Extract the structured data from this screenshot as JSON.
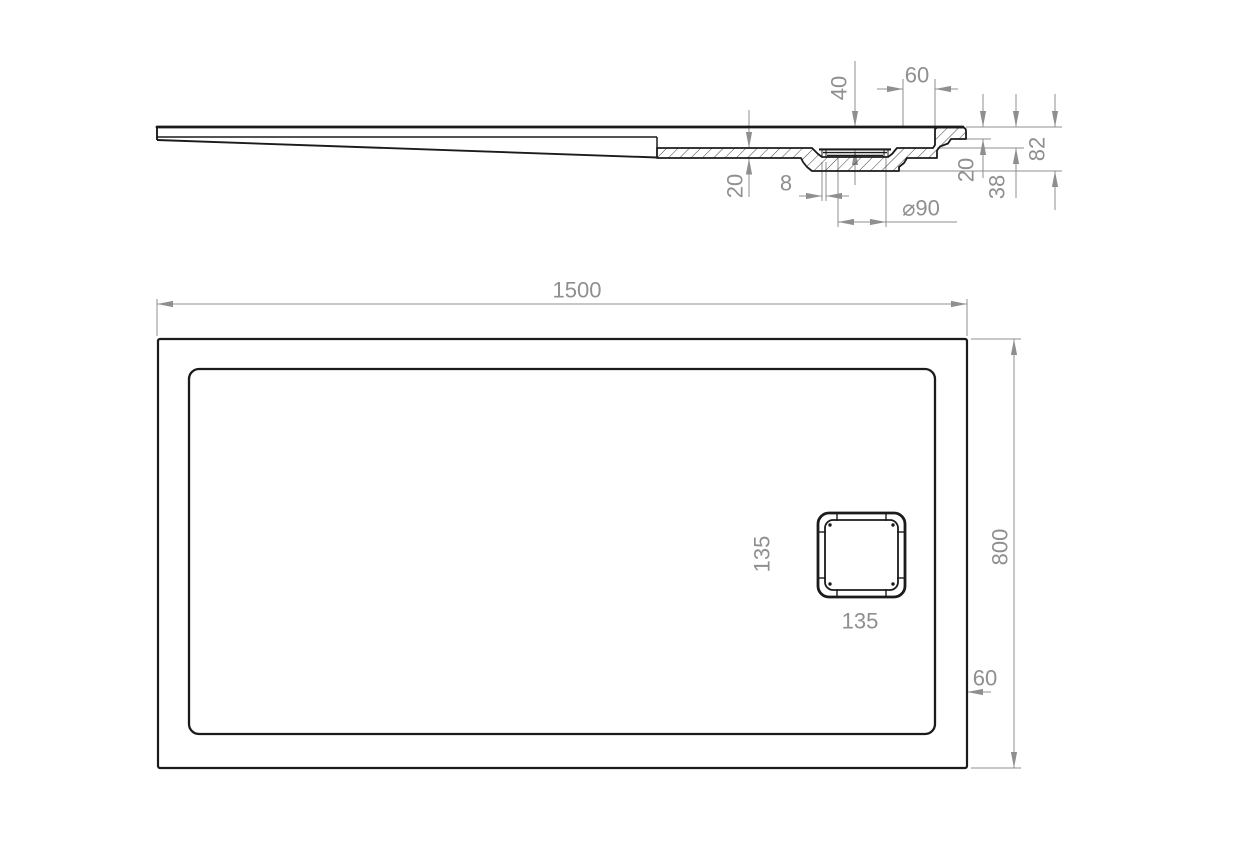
{
  "colors": {
    "drawing_line": "#1b1b1b",
    "dimension": "#8f8f8f",
    "background": "#ffffff"
  },
  "section_view": {
    "dims": {
      "drain_depth": "40",
      "drain_to_wall": "60",
      "base_thickness": "20",
      "lip": "8",
      "drain_diameter": "⌀90",
      "edge_step": "20",
      "edge_height": "38",
      "total_height": "82"
    }
  },
  "plan_view": {
    "dims": {
      "length": "1500",
      "width": "800",
      "drain_height": "135",
      "drain_width": "135",
      "edge_offset": "60"
    }
  }
}
